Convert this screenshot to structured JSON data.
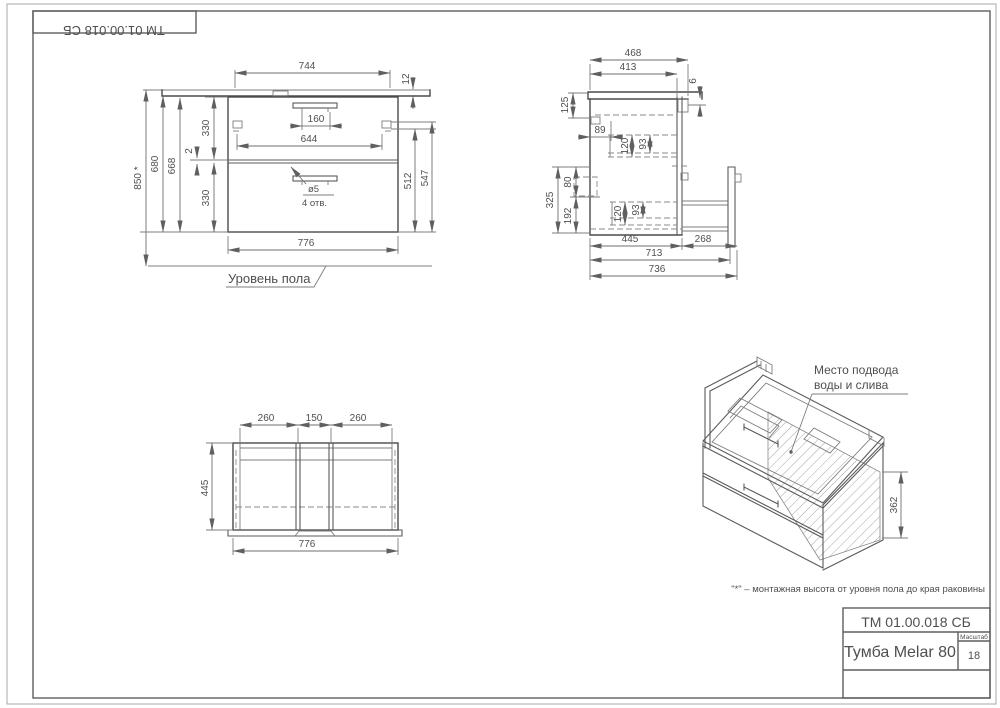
{
  "sheet": {
    "stamp": "ТМ 01.00.018 СБ",
    "footnote": "\"*\" – монтажная высота от уровня пола до края раковины",
    "title_block": {
      "code": "ТМ 01.00.018 СБ",
      "product": "Тумба Melar 80",
      "scale_label": "Масштаб",
      "scale_value": "18"
    }
  },
  "front_view": {
    "dims": {
      "w744": "744",
      "t12": "12",
      "h160": "160",
      "s644": "644",
      "h850": "850 *",
      "h680": "680",
      "h668": "668",
      "u330": "330",
      "g2": "2",
      "l330": "330",
      "r512": "512",
      "r547": "547",
      "w776": "776"
    },
    "hole_dia": "ø5",
    "hole_count": "4 отв.",
    "floor_label": "Уровень пола"
  },
  "side_view": {
    "dims": {
      "d468": "468",
      "d413": "413",
      "g6": "6",
      "t125": "125",
      "c89": "89",
      "u120": "120",
      "u93": "93",
      "l325": "325",
      "l80": "80",
      "l192": "192",
      "b120": "120",
      "b93": "93",
      "b445": "445",
      "b268": "268",
      "b713": "713",
      "b736": "736"
    }
  },
  "top_view": {
    "dims": {
      "l260": "260",
      "c150": "150",
      "r260": "260",
      "d445": "445",
      "w776": "776"
    }
  },
  "iso_view": {
    "note_line1": "Место подвода",
    "note_line2": "воды и слива",
    "d362": "362"
  }
}
